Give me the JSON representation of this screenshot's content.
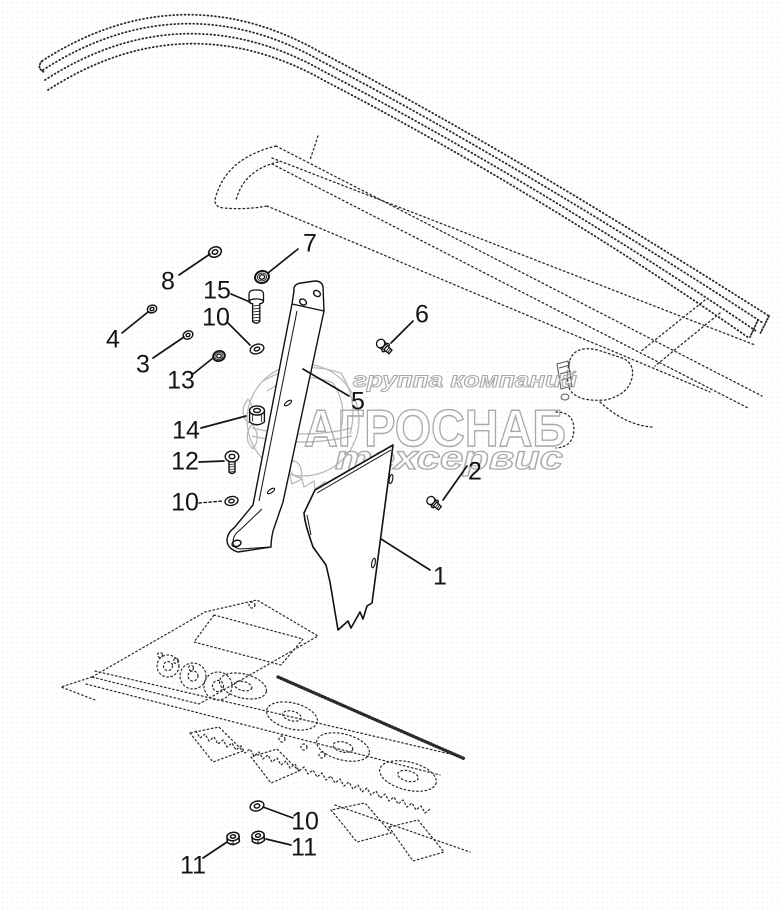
{
  "document": {
    "kind": "exploded-parts-diagram",
    "description_visible_text_only": true
  },
  "watermark": {
    "line1": "группа компаний",
    "brand": "АГРОСНАБ",
    "line2": "техсервис",
    "color": "#a8a8a8"
  },
  "callouts": [
    {
      "label": "1"
    },
    {
      "label": "2"
    },
    {
      "label": "3"
    },
    {
      "label": "4"
    },
    {
      "label": "5"
    },
    {
      "label": "6"
    },
    {
      "label": "7"
    },
    {
      "label": "8"
    },
    {
      "label": "10"
    },
    {
      "label": "10"
    },
    {
      "label": "10"
    },
    {
      "label": "11"
    },
    {
      "label": "11"
    },
    {
      "label": "12"
    },
    {
      "label": "13"
    },
    {
      "label": "14"
    },
    {
      "label": "15"
    }
  ],
  "colors": {
    "ink": "#1a1a1a",
    "phantom_line": "#2a2a2a",
    "watermark": "#a8a8a8",
    "background": "#ffffff"
  }
}
